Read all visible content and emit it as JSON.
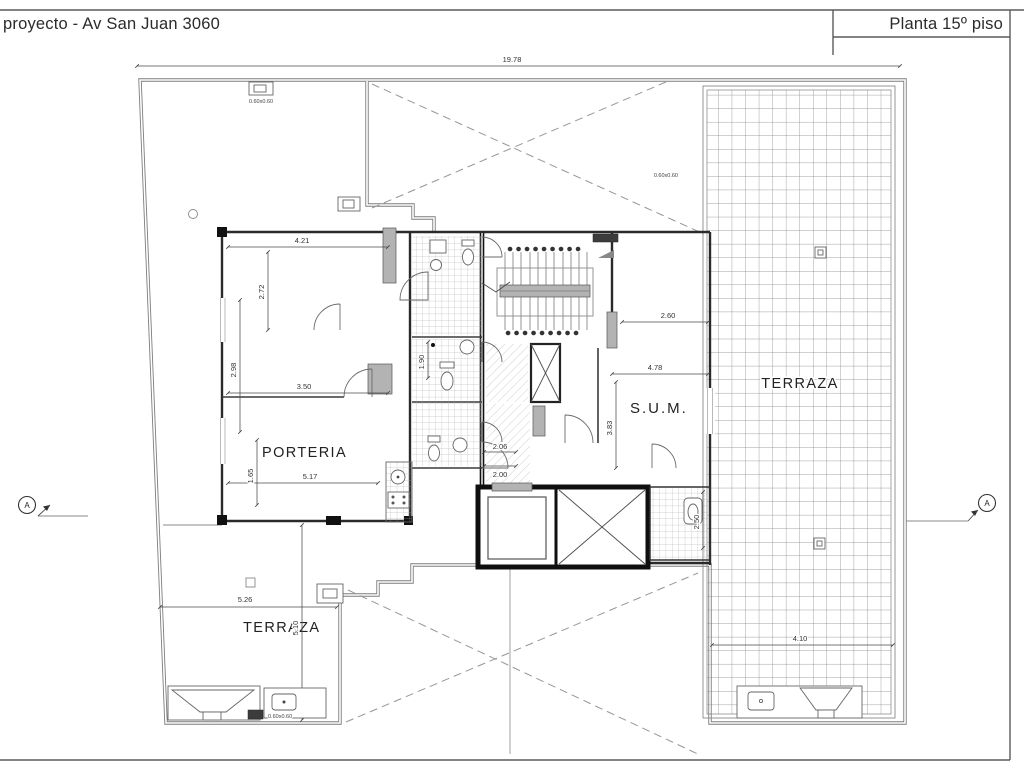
{
  "header": {
    "project_title": "proyecto - Av San Juan 3060",
    "sheet_title": "Planta 15º piso"
  },
  "rooms": {
    "porteria": "PORTERIA",
    "sum": "S.U.M.",
    "terraza_right": "TERRAZA",
    "terraza_bottom": "TERRAZA"
  },
  "section_markers": {
    "left": "A",
    "right": "A"
  },
  "dimensions": {
    "total_width": "19.78",
    "bedroom_width": "4.21",
    "bedroom_depth": "2.72",
    "living_width": "3.50",
    "living_depth": "2.98",
    "porteria_width": "5.17",
    "porteria_niche": "1.65",
    "terraza_bottom_width": "5.26",
    "terraza_bottom_depth": "5.10",
    "sum_east_opening": "2.60",
    "sum_width": "4.78",
    "sum_depth": "3.83",
    "hall_a": "2.06",
    "hall_b": "2.00",
    "hall_c": "1.90",
    "terraza_right_width": "4.10",
    "bath_depth": "2.50"
  },
  "annotations": {
    "drain_label_1": "0.60x0.60",
    "drain_label_2": "0.60x0.60",
    "drain_label_3": "0.60x0.60"
  },
  "colors": {
    "background": "#ffffff",
    "line": "#7d7d7d",
    "wall": "#1c1c1c",
    "text": "#2b2b2b",
    "hatch_fill": "#b3b3b3"
  }
}
